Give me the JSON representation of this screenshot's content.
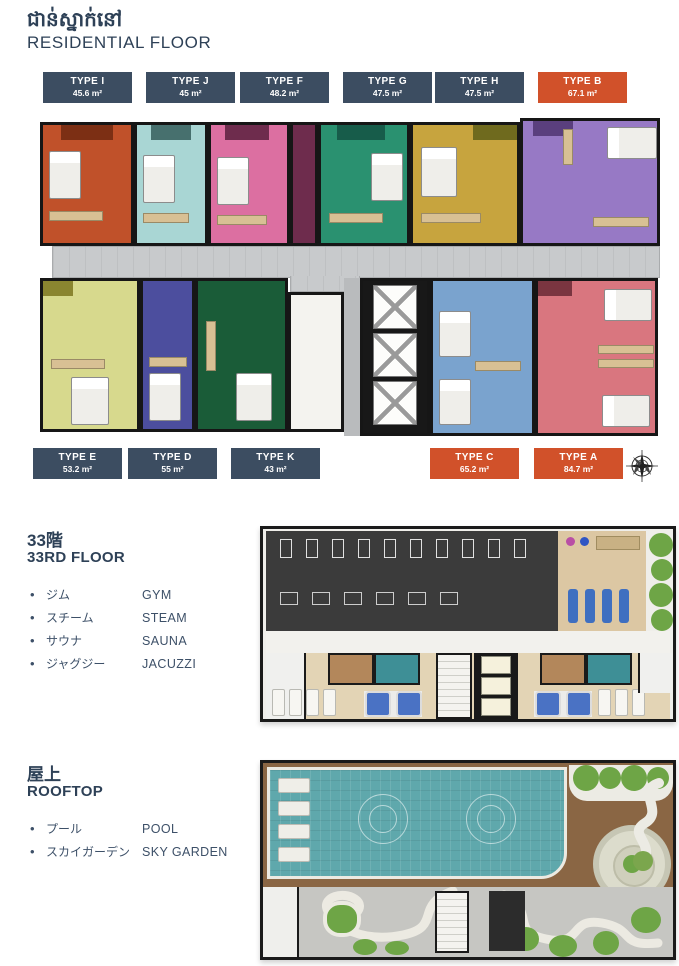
{
  "header": {
    "title_khmer": "ជាន់ស្នាក់នៅ",
    "title_en": "RESIDENTIAL FLOOR"
  },
  "palette": {
    "heading_navy": "#2e4157",
    "badge_navy": "#3c4d61",
    "badge_orange": "#d1512a"
  },
  "residential": {
    "badges_top": [
      {
        "type": "TYPE I",
        "area": "45.6 m²",
        "highlight": false
      },
      {
        "type": "TYPE J",
        "area": "45 m²",
        "highlight": false
      },
      {
        "type": "TYPE F",
        "area": "48.2 m²",
        "highlight": false
      },
      {
        "type": "TYPE G",
        "area": "47.5 m²",
        "highlight": false
      },
      {
        "type": "TYPE H",
        "area": "47.5 m²",
        "highlight": false
      },
      {
        "type": "TYPE B",
        "area": "67.1 m²",
        "highlight": true
      }
    ],
    "badges_bottom": [
      {
        "type": "TYPE E",
        "area": "53.2 m²",
        "highlight": false
      },
      {
        "type": "TYPE D",
        "area": "55 m²",
        "highlight": false
      },
      {
        "type": "TYPE K",
        "area": "43 m²",
        "highlight": false
      },
      {
        "type": "TYPE C",
        "area": "65.2 m²",
        "highlight": true
      },
      {
        "type": "TYPE A",
        "area": "84.7 m²",
        "highlight": true
      }
    ],
    "compass": {
      "n": "N",
      "e": "E",
      "s": "S",
      "w": "W"
    }
  },
  "floor33": {
    "title_jp": "33階",
    "title_en": "33RD FLOOR",
    "amenities": [
      {
        "jp": "ジム",
        "en": "GYM"
      },
      {
        "jp": "スチーム",
        "en": "STEAM"
      },
      {
        "jp": "サウナ",
        "en": "SAUNA"
      },
      {
        "jp": "ジャグジー",
        "en": "JACUZZI"
      }
    ]
  },
  "rooftop": {
    "title_jp": "屋上",
    "title_en": "ROOFTOP",
    "amenities": [
      {
        "jp": "プール",
        "en": "POOL"
      },
      {
        "jp": "スカイガーデン",
        "en": "SKY GARDEN"
      }
    ]
  },
  "plan_colors": {
    "unit_i": "#c0512a",
    "unit_j": "#a9d6d4",
    "unit_f": "#dc6fa1",
    "unit_maroon": "#6e2c4d",
    "unit_g": "#2a9170",
    "unit_h": "#c7a43e",
    "unit_b": "#9779c5",
    "unit_e": "#d7d98d",
    "unit_d": "#4c4e9e",
    "unit_k": "#1a5c38",
    "unit_c": "#7aa3ce",
    "unit_a": "#d9767f",
    "wall": "#161616",
    "corridor": "#c8cacc",
    "stair_white": "#f4f3ef",
    "gym_dark": "#3b3b3b",
    "spa_beige": "#e3d4b5",
    "sauna_wood": "#b3875b",
    "steam_teal": "#3e8f96",
    "jacuzzi_blue": "#4a72c4",
    "greenery": "#6ea546",
    "pool_teal": "#5fa8ac",
    "deck_wood": "#8a6644",
    "paving_gray": "#c6c6c2"
  }
}
